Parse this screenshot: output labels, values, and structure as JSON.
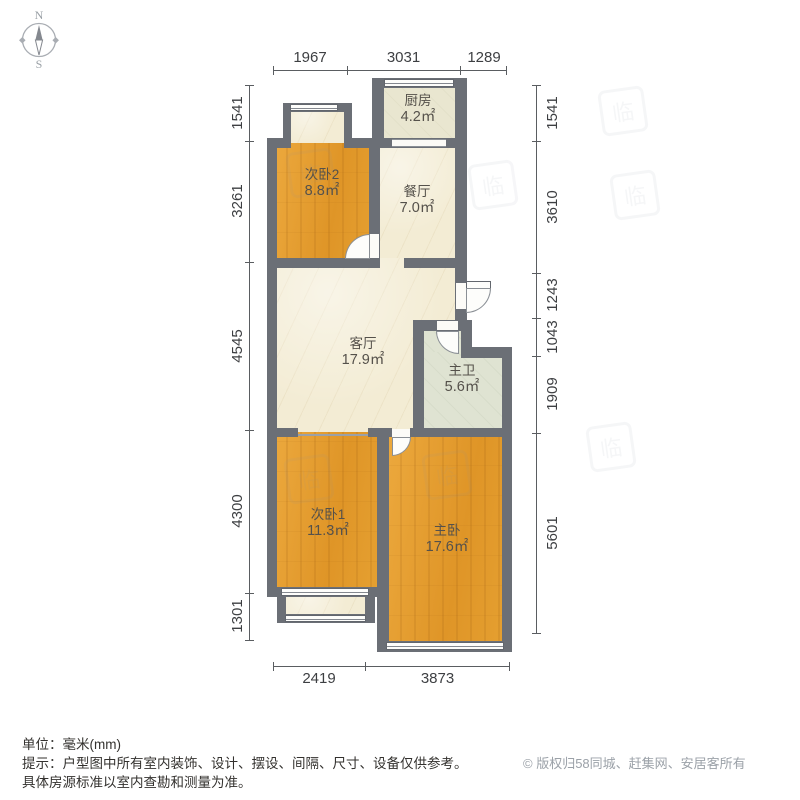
{
  "compass": {
    "north": "N",
    "south": "S"
  },
  "rooms": [
    {
      "id": "kitchen",
      "name": "厨房",
      "area": "4.2㎡"
    },
    {
      "id": "bedroom2",
      "name": "次卧2",
      "area": "8.8㎡"
    },
    {
      "id": "dining",
      "name": "餐厅",
      "area": "7.0㎡"
    },
    {
      "id": "living",
      "name": "客厅",
      "area": "17.9㎡"
    },
    {
      "id": "master-bath",
      "name": "主卫",
      "area": "5.6㎡"
    },
    {
      "id": "bedroom1",
      "name": "次卧1",
      "area": "11.3㎡"
    },
    {
      "id": "master-bedroom",
      "name": "主卧",
      "area": "17.6㎡"
    }
  ],
  "dimensions": {
    "top": [
      "1967",
      "3031",
      "1289"
    ],
    "bottom": [
      "2419",
      "3873"
    ],
    "left": [
      "1541",
      "3261",
      "4545",
      "4300",
      "1301"
    ],
    "right": [
      "1541",
      "3610",
      "1243",
      "1043",
      "1909",
      "5601"
    ]
  },
  "footer": {
    "unit_line": "单位：毫米(mm)",
    "hint_line1": "提示：户型图中所有室内装饰、设计、摆设、间隔、尺寸、设备仅供参考。",
    "hint_line2": "具体房源标准以室内查勘和测量为准。",
    "copyright": "© 版权归58同城、赶集网、安居客所有"
  },
  "watermark": {
    "glyph": "临"
  },
  "colors": {
    "wall": "#6b6f76",
    "wood_floor": "#e3992d",
    "marble_floor": "#f3ecd4",
    "kitchen_tile": "#e9e6d0",
    "bath_tile": "#dfe3d2",
    "dim_text": "#3d3f42",
    "footer_text": "#33312e",
    "copyright_text": "#9ba1a8"
  }
}
